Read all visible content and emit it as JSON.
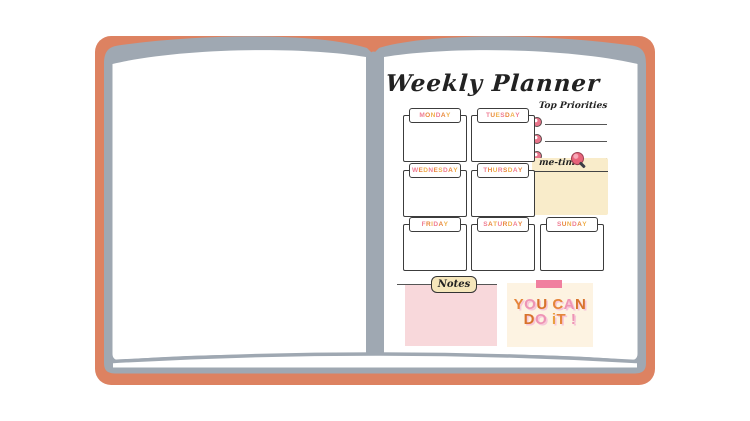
{
  "notebook": {
    "cover_color": "#dd8261",
    "page_edge_color": "#9fa8b2",
    "paper_color": "#ffffff"
  },
  "planner": {
    "title": "Weekly Planner",
    "days": [
      {
        "name": "MONDAY"
      },
      {
        "name": "TUESDAY"
      },
      {
        "name": "WEDNESDAY"
      },
      {
        "name": "THURSDAY"
      },
      {
        "name": "FRIDAY"
      },
      {
        "name": "SATURDAY"
      },
      {
        "name": "SUNDAY"
      }
    ],
    "day_letter_colors": [
      "#ef7d94",
      "#e8873c",
      "#f0b04a"
    ],
    "priorities": {
      "label": "Top Priorities",
      "rows": 3,
      "bullet_color": "#e8748a"
    },
    "me_time": {
      "label": "me-time",
      "bg_color": "#f9ecca",
      "pin_color": "#e8647a"
    },
    "notes": {
      "label": "Notes",
      "box_color": "#f8d8db",
      "tab_color": "#f5e6bb"
    },
    "motivation": {
      "bg_color": "#fdf3e2",
      "tape_color": "#f07f9f",
      "text": "YOU CAN DO IT!",
      "lines": [
        {
          "letters": [
            {
              "ch": "Y",
              "color": "#e5853a"
            },
            {
              "ch": "O",
              "color": "#ee94b5"
            },
            {
              "ch": "U",
              "color": "#d8732c"
            },
            {
              "ch": " ",
              "color": ""
            },
            {
              "ch": "C",
              "color": "#e5853a"
            },
            {
              "ch": "A",
              "color": "#ee94b5"
            },
            {
              "ch": "N",
              "color": "#d8732c"
            }
          ]
        },
        {
          "letters": [
            {
              "ch": "D",
              "color": "#d8732c"
            },
            {
              "ch": "O",
              "color": "#ee94b5"
            },
            {
              "ch": " ",
              "color": ""
            },
            {
              "ch": "i",
              "color": "#e9a03f"
            },
            {
              "ch": "T",
              "color": "#e5853a"
            },
            {
              "ch": " ",
              "color": ""
            },
            {
              "ch": "!",
              "color": "#ee94b5"
            }
          ]
        }
      ]
    }
  }
}
